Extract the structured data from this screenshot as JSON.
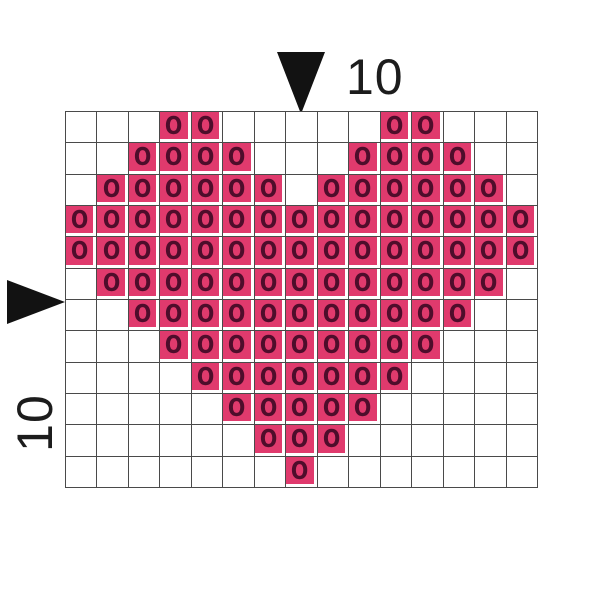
{
  "pattern": {
    "columns": 15,
    "rows": 12,
    "stitch_symbol": "O",
    "fill_color": "#E03A6D",
    "symbol_color": "#4E0D2B",
    "grid_line_color": "#4a4a4a",
    "grid": [
      "...OO.....OO...",
      "..OOOO...OOOO..",
      ".OOOOOO.OOOOOO.",
      "OOOOOOOOOOOOOOO",
      "OOOOOOOOOOOOOOO",
      ".OOOOOOOOOOOOO.",
      "..OOOOOOOOOOO..",
      "...OOOOOOOOO...",
      "....OOOOOOO....",
      ".....OOOOO.....",
      "......OOO......",
      ".......O......."
    ]
  },
  "markers": {
    "top": {
      "label": "10"
    },
    "left": {
      "label": "10"
    }
  }
}
